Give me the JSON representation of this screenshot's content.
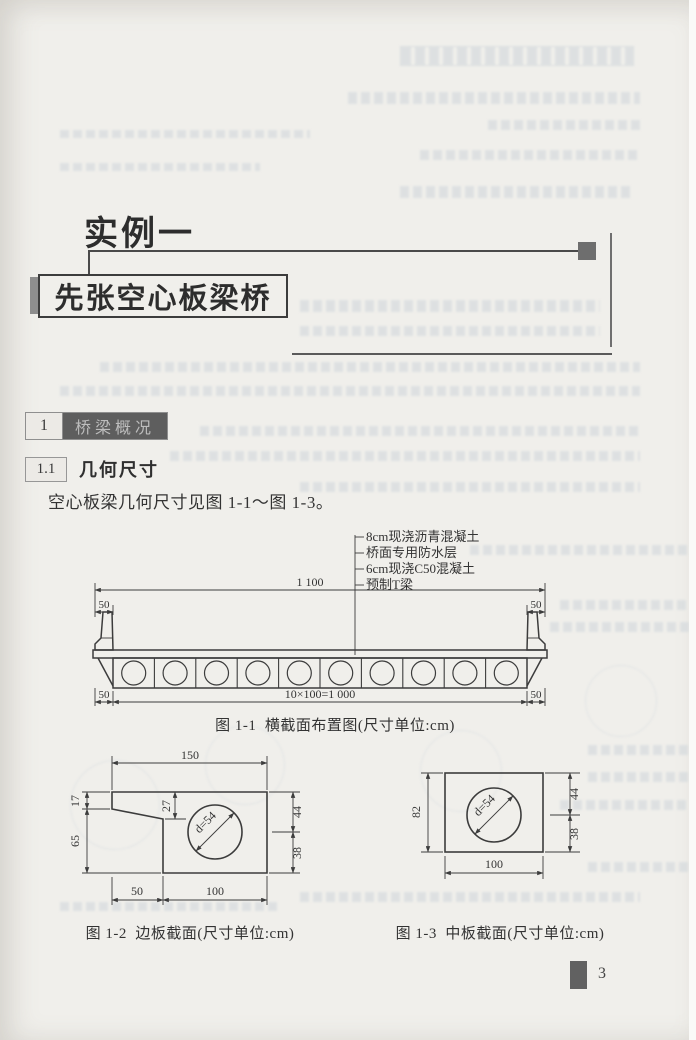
{
  "page": {
    "number": "3"
  },
  "header": {
    "example_title": "实例一",
    "bridge_title": "先张空心板梁桥"
  },
  "sections": {
    "s1": {
      "number": "1",
      "title": "桥梁概况"
    },
    "s1_1": {
      "number": "1.1",
      "title": "几何尺寸"
    }
  },
  "body": {
    "intro": "空心板梁几何尺寸见图 1-1～图 1-3。"
  },
  "figures": {
    "fig1": {
      "caption": "图 1-1  横截面布置图(尺寸单位:cm)",
      "callouts": [
        "8cm现浇沥青混凝土",
        "桥面专用防水层",
        "6cm现浇C50混凝土",
        "预制T梁"
      ],
      "dims": {
        "overall": "1 100",
        "edge": "50",
        "slabs": "10×100=1 000"
      },
      "void_count": 10
    },
    "fig2": {
      "caption": "图 1-2  边板截面(尺寸单位:cm)",
      "dims": {
        "top": "150",
        "left_upper": "17",
        "left_lower": "65",
        "flange": "27",
        "right_upper": "44",
        "right_lower": "38",
        "bottom_left": "50",
        "bottom_right": "100",
        "void": "d=54"
      }
    },
    "fig3": {
      "caption": "图 1-3  中板截面(尺寸单位:cm)",
      "dims": {
        "left": "82",
        "right_upper": "44",
        "right_lower": "38",
        "bottom": "100",
        "void": "d=54"
      }
    }
  }
}
